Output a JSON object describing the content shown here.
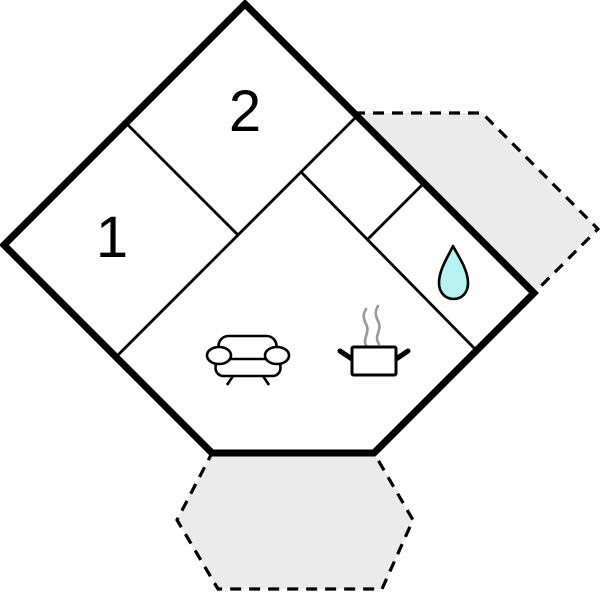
{
  "diagram": {
    "kind": "floor-plan",
    "rooms": [
      {
        "name": "room-1",
        "label": "1"
      },
      {
        "name": "room-2",
        "label": "2"
      }
    ],
    "icons": [
      {
        "name": "sofa-icon"
      },
      {
        "name": "cooking-pot-icon"
      },
      {
        "name": "steam-icon"
      },
      {
        "name": "water-drop-icon"
      }
    ],
    "colors": {
      "wall": "#000000",
      "terrace_fill": "#ebebeb",
      "water_drop_fill": "#b8f2f2",
      "steam": "#999999",
      "background": "#ffffff"
    }
  }
}
